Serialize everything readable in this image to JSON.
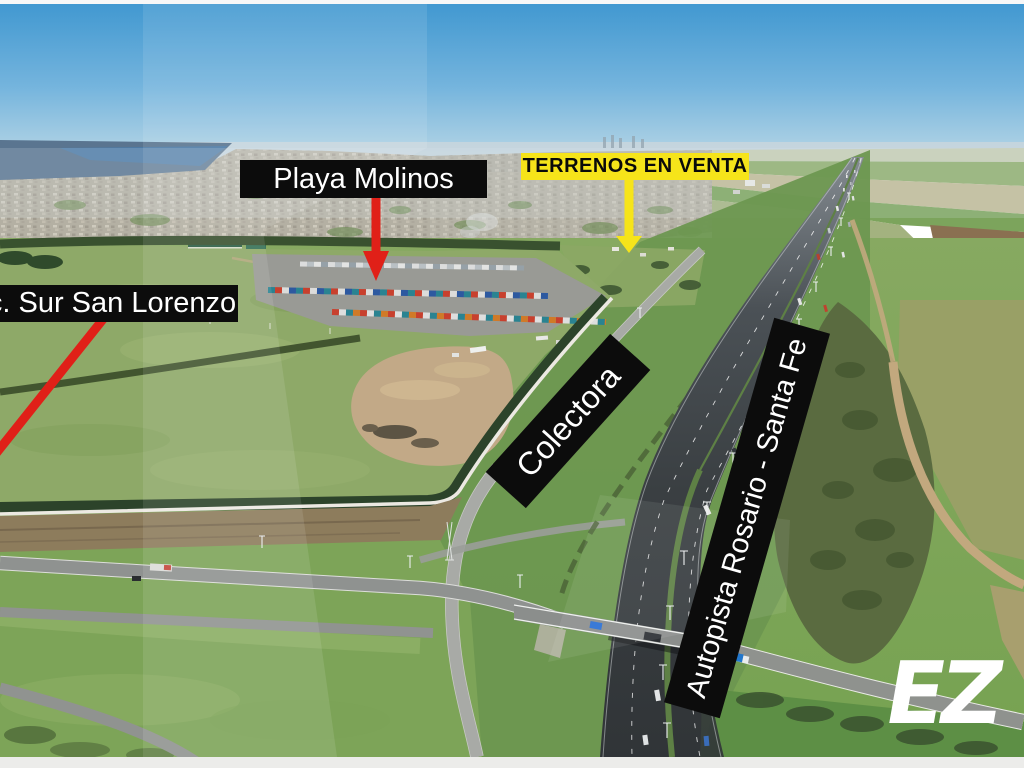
{
  "labels": {
    "playa_molinos": "Playa Molinos",
    "terrenos_en_venta": "TERRENOS EN VENTA",
    "acceso_sur_san_lorenzo": "c. Sur San Lorenzo",
    "colectora": "Colectora",
    "autopista_rosario_santa_fe": "Autopista Rosario - Santa Fe"
  },
  "watermark": {
    "text": "EZ"
  },
  "colors": {
    "annotation_black": "#0c0c0c",
    "annotation_text_white": "#ffffff",
    "highlight_yellow": "#f6e41a",
    "arrow_red": "#e02018"
  }
}
